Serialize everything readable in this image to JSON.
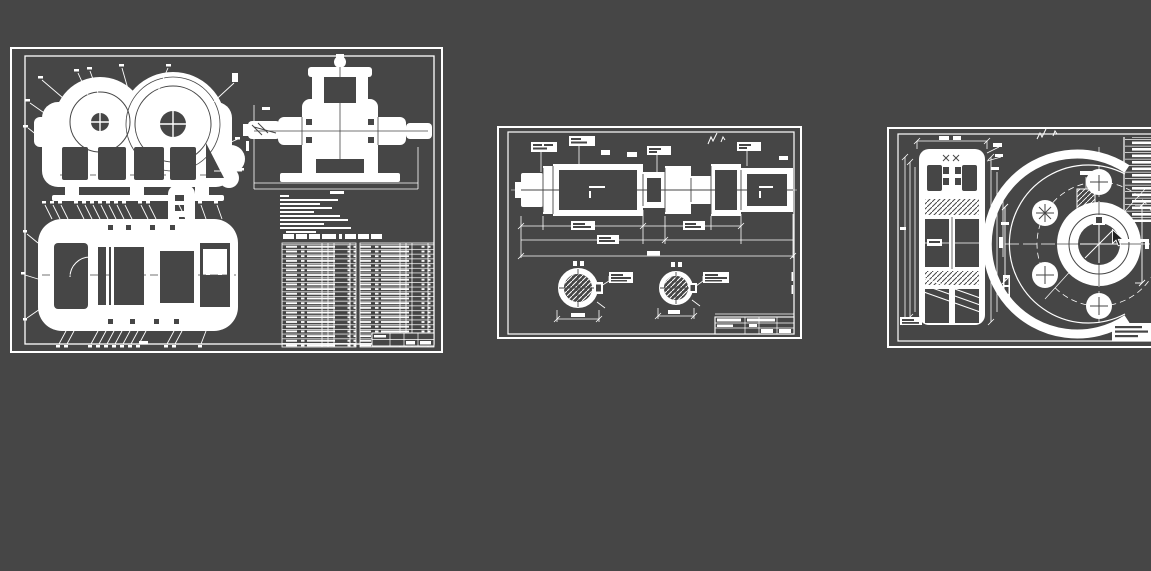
{
  "workspace": {
    "description": "CAD drawing workspace, white-on-dark preview of three engineering drawing sheets",
    "background_color": "#464646",
    "ink_color": "#ffffff",
    "sheet_count": 3
  },
  "cursor": {
    "name": "arrow-cursor",
    "x": 1113,
    "y": 230,
    "fill": "#222222",
    "outline": "#ffffff"
  },
  "sheets": [
    {
      "name": "assembly-drawing-sheet",
      "x": 10,
      "y": 47,
      "width": 433,
      "height": 306,
      "views": [
        "front-section-view-with-gears",
        "side-elevation-view",
        "top-section-view",
        "detail-stub"
      ],
      "leader_callouts_top_view": 11,
      "leader_callouts_plan_top": 16,
      "leader_callouts_plan_bottom": 12,
      "technical_requirements_lines": 11,
      "bom_table": {
        "halves": 2,
        "rows_per_half": 22,
        "columns_per_half": 5
      },
      "title_block_present": true
    },
    {
      "name": "shaft-drawing-sheet",
      "x": 497,
      "y": 126,
      "width": 305,
      "height": 213,
      "views": [
        "stepped-shaft-main-view",
        "cross-section-left",
        "cross-section-right"
      ],
      "dimension_callout_boxes": 8,
      "surface_finish_marks": 2,
      "title_block_present": true
    },
    {
      "name": "gear-drawing-sheet",
      "x": 887,
      "y": 127,
      "width": 264,
      "height": 221,
      "clipped_by_viewport_right": true,
      "views": [
        "gear-axial-section-view",
        "gear-front-view"
      ],
      "lightening_holes_visible": 4,
      "parameter_table_rows": 13,
      "note_block_lines": 3
    }
  ]
}
